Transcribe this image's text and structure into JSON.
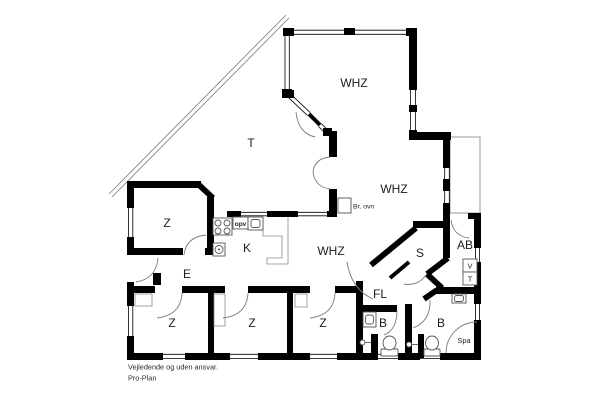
{
  "plan": {
    "rooms": {
      "whz_top": "WHZ",
      "whz_mid": "WHZ",
      "whz_lower": "WHZ",
      "terrace": "T",
      "z_upper": "Z",
      "kitchen": "K",
      "entry": "E",
      "storage": "S",
      "utility": "AB",
      "hall": "FL",
      "bedroom1": "Z",
      "bedroom2": "Z",
      "bedroom3": "Z",
      "bath1": "B",
      "bath2": "B"
    },
    "annotations": {
      "spa": "Spa",
      "washer": "V",
      "dryer": "T",
      "dishwasher": "opv",
      "wood_stove": "Br. ovn"
    },
    "footer": {
      "line1": "Vejledende og uden ansvar.",
      "line2": "Pro-Plan"
    },
    "colors": {
      "wall": "#000000",
      "background": "#ffffff",
      "door_arc": "#7a7a7a",
      "fixture_outline": "#555555",
      "terrace_outline": "#9a9a9a"
    }
  }
}
